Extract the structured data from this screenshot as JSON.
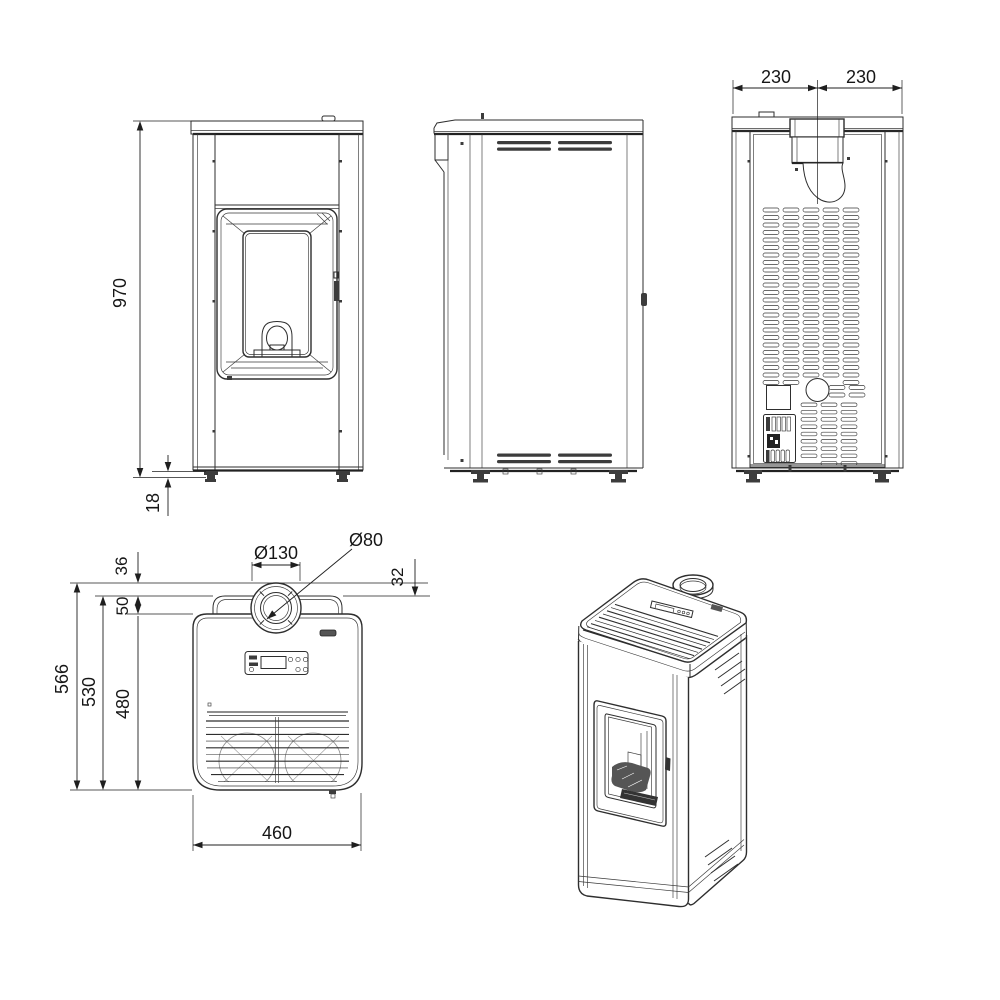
{
  "diagram": {
    "type": "technical-drawing",
    "subject": "pellet stove dimensioned views: front, side, rear, top, isometric",
    "background": "#ffffff",
    "line_color": "#2e2e2e",
    "dimensions": {
      "front_height": "970",
      "front_base_height": "18",
      "rear_flue_left": "230",
      "rear_flue_right": "230",
      "width": "460",
      "depth_total": "566",
      "depth_mid": "530",
      "depth_body": "480",
      "collar_to_back": "36",
      "collar_side_offset": "32",
      "hump_depth": "50",
      "flue_collar_diameter": "Ø130",
      "flue_pipe_diameter": "Ø80"
    }
  }
}
